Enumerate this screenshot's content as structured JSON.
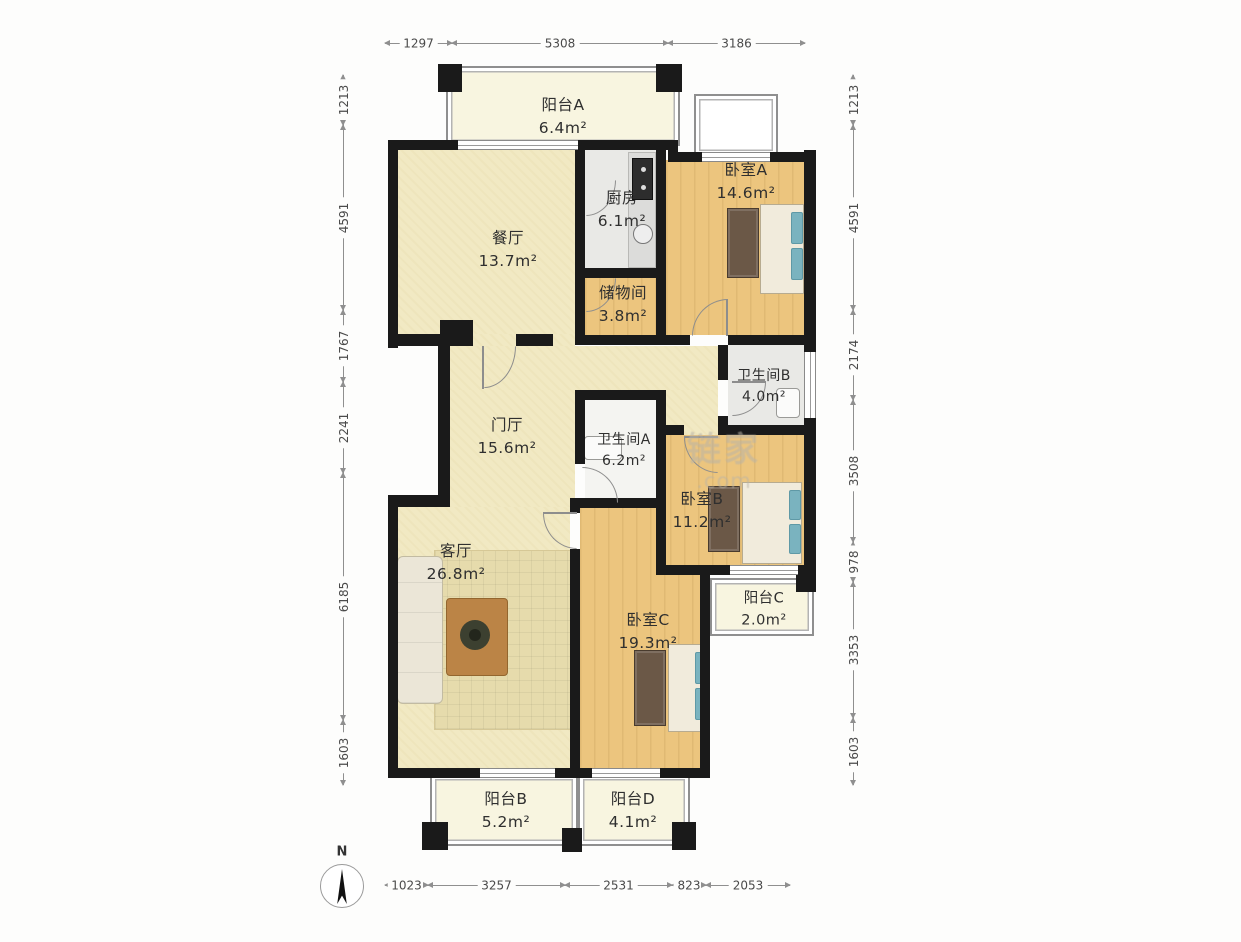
{
  "compass": {
    "label": "N"
  },
  "watermark": {
    "brand": "链家",
    "suffix": ".com"
  },
  "rooms": {
    "balcony_a": {
      "name": "阳台A",
      "area": "6.4m²"
    },
    "dining": {
      "name": "餐厅",
      "area": "13.7m²"
    },
    "kitchen": {
      "name": "厨房",
      "area": "6.1m²"
    },
    "bedroom_a": {
      "name": "卧室A",
      "area": "14.6m²"
    },
    "storage": {
      "name": "储物间",
      "area": "3.8m²"
    },
    "bath_b": {
      "name": "卫生间B",
      "area": "4.0m²"
    },
    "hall": {
      "name": "门厅",
      "area": "15.6m²"
    },
    "bath_a": {
      "name": "卫生间A",
      "area": "6.2m²"
    },
    "bedroom_b": {
      "name": "卧室B",
      "area": "11.2m²"
    },
    "living": {
      "name": "客厅",
      "area": "26.8m²"
    },
    "balcony_c": {
      "name": "阳台C",
      "area": "2.0m²"
    },
    "bedroom_c": {
      "name": "卧室C",
      "area": "19.3m²"
    },
    "balcony_b": {
      "name": "阳台B",
      "area": "5.2m²"
    },
    "balcony_d": {
      "name": "阳台D",
      "area": "4.1m²"
    }
  },
  "dimensions": {
    "top": [
      "1297",
      "5308",
      "3186"
    ],
    "bottom": [
      "1023",
      "3257",
      "2531",
      "823",
      "2053"
    ],
    "left": [
      "1213",
      "4591",
      "1767",
      "2241",
      "6185",
      "1603"
    ],
    "right": [
      "1213",
      "4591",
      "2174",
      "3508",
      "978",
      "3353",
      "1603"
    ]
  },
  "colors": {
    "wall": "#1a1a1a",
    "floor_wood": "#ecc57e",
    "floor_beige": "#f1e9c3",
    "floor_gray": "#e9e9e6",
    "floor_cream": "#f8f5e0",
    "dim_line": "#8f8f8f",
    "label_text": "#2f2f2f",
    "pillow": "#7ab3bf"
  }
}
